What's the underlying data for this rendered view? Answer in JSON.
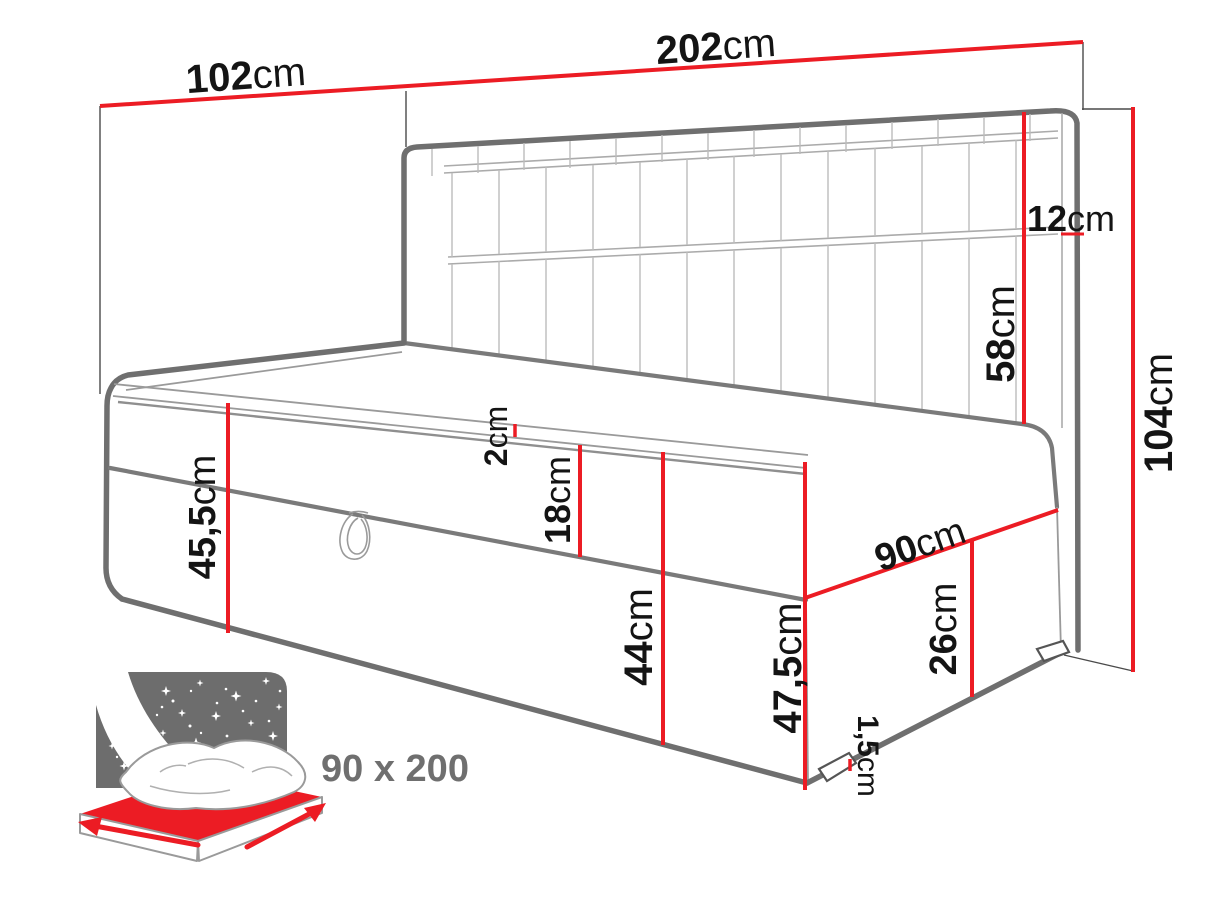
{
  "diagram": {
    "type": "furniture-dimension-drawing",
    "subject": "upholstered daybed with storage, headboard shelf and side panel",
    "dimensions": {
      "depth_total": {
        "num": "102",
        "unit": "cm"
      },
      "length_total": {
        "num": "202",
        "unit": "cm"
      },
      "headboard_thickness": {
        "num": "12",
        "unit": "cm"
      },
      "headboard_height": {
        "num": "58",
        "unit": "cm"
      },
      "total_height": {
        "num": "104",
        "unit": "cm"
      },
      "side_height_left": {
        "num": "45,5",
        "unit": "cm"
      },
      "topper_thickness": {
        "num": "2",
        "unit": "cm"
      },
      "mattress_thickness": {
        "num": "18",
        "unit": "cm"
      },
      "platform_height": {
        "num": "44",
        "unit": "cm"
      },
      "side_height_right": {
        "num": "47,5",
        "unit": "cm"
      },
      "sleep_width": {
        "num": "90",
        "unit": "cm"
      },
      "base_height": {
        "num": "26",
        "unit": "cm"
      },
      "leg_height": {
        "num": "1,5",
        "unit": "cm"
      }
    },
    "size_badge": {
      "label": "90 x 200"
    },
    "colors": {
      "dimension_red": "#EC1C24",
      "outline_gray": "#6F6F6F",
      "icon_gray": "#6D6D6D",
      "label_black": "#141414",
      "background": "#FFFFFF"
    }
  }
}
